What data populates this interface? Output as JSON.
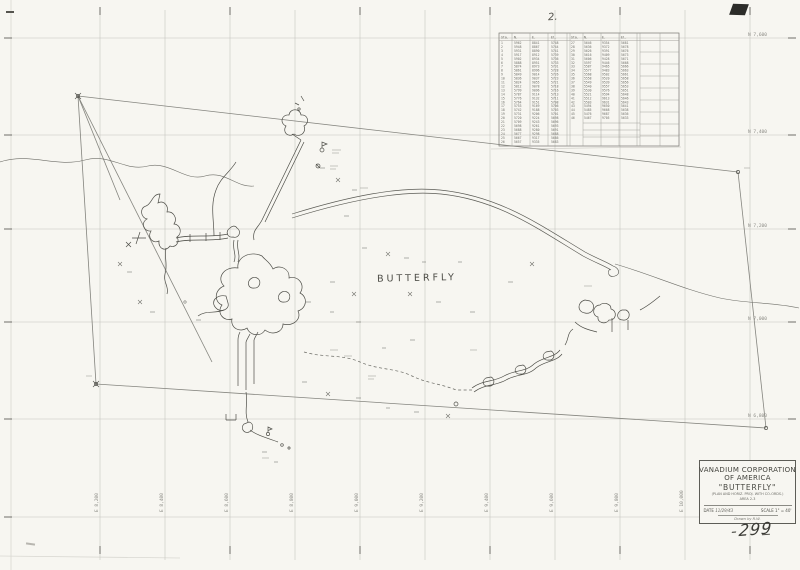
{
  "annotations": {
    "page_number": "299",
    "sheet_note": "2.",
    "map_label": "BUTTERFLY"
  },
  "title_block": {
    "company_line1": "VANADIUM CORPORATION",
    "company_line2": "OF AMERICA",
    "map_name": "\"BUTTERFLY\"",
    "subtitle": "(PLAN AND HORIZ. PROJ. WITH CO-ORDS.)",
    "area_line": "AREA 2-3",
    "date_label": "DATE",
    "date_value": "11/29/43",
    "scale_label": "SCALE",
    "scale_value": "1\" = 40'",
    "credit_line": "Drawn by R.W."
  },
  "grid": {
    "eastings": [
      {
        "x": 100,
        "label": "E 8,200"
      },
      {
        "x": 165,
        "label": "E 8,400"
      },
      {
        "x": 230,
        "label": "E 8,600"
      },
      {
        "x": 295,
        "label": "E 8,800"
      },
      {
        "x": 360,
        "label": "E 9,000"
      },
      {
        "x": 425,
        "label": "E 9,200"
      },
      {
        "x": 490,
        "label": "E 9,400"
      },
      {
        "x": 555,
        "label": "E 9,600"
      },
      {
        "x": 620,
        "label": "E 9,800"
      },
      {
        "x": 685,
        "label": "E 10,000"
      },
      {
        "x": 750,
        "label": "E 10,200"
      }
    ],
    "northings": [
      {
        "y": 38,
        "label": "N 7,600"
      },
      {
        "y": 135,
        "label": "N 7,400"
      },
      {
        "y": 229,
        "label": "N 7,200"
      },
      {
        "y": 322,
        "label": "N 7,000"
      },
      {
        "y": 419,
        "label": "N 6,800"
      },
      {
        "y": 517,
        "label": "N 6,600"
      }
    ]
  },
  "station_table": {
    "left_headers": [
      "Sta.",
      "N.",
      "E.",
      "El."
    ],
    "right_headers": [
      "Sta.",
      "N.",
      "E.",
      "El."
    ],
    "left_rows": [
      [
        "1",
        "5962",
        "8841",
        "5748"
      ],
      [
        "2",
        "5948",
        "8867",
        "5744"
      ],
      [
        "3",
        "5931",
        "8890",
        "5741"
      ],
      [
        "4",
        "5917",
        "8912",
        "5739"
      ],
      [
        "5",
        "5902",
        "8934",
        "5736"
      ],
      [
        "6",
        "5888",
        "8951",
        "5733"
      ],
      [
        "7",
        "5874",
        "8973",
        "5731"
      ],
      [
        "8",
        "5861",
        "8996",
        "5728"
      ],
      [
        "9",
        "5849",
        "9014",
        "5726"
      ],
      [
        "10",
        "5836",
        "9037",
        "5723"
      ],
      [
        "11",
        "5824",
        "9055",
        "5721"
      ],
      [
        "12",
        "5812",
        "9078",
        "5718"
      ],
      [
        "13",
        "5799",
        "9096",
        "5716"
      ],
      [
        "14",
        "5787",
        "9114",
        "5713"
      ],
      [
        "15",
        "5776",
        "9132",
        "5711"
      ],
      [
        "16",
        "5764",
        "9151",
        "5708"
      ],
      [
        "17",
        "5753",
        "9169",
        "5706"
      ],
      [
        "18",
        "5742",
        "9188",
        "5703"
      ],
      [
        "19",
        "5731",
        "9206",
        "5701"
      ],
      [
        "20",
        "5720",
        "9224",
        "5698"
      ],
      [
        "21",
        "5709",
        "9243",
        "5696"
      ],
      [
        "22",
        "5698",
        "9261",
        "5693"
      ],
      [
        "23",
        "5688",
        "9280",
        "5691"
      ],
      [
        "24",
        "5677",
        "9298",
        "5688"
      ],
      [
        "25",
        "5667",
        "9317",
        "5686"
      ],
      [
        "26",
        "5657",
        "9335",
        "5683"
      ]
    ],
    "right_rows": [
      [
        "27",
        "5646",
        "9354",
        "5681"
      ],
      [
        "28",
        "5636",
        "9372",
        "5678"
      ],
      [
        "29",
        "5626",
        "9391",
        "5676"
      ],
      [
        "30",
        "5616",
        "9409",
        "5673"
      ],
      [
        "31",
        "5606",
        "9428",
        "5671"
      ],
      [
        "32",
        "5597",
        "9446",
        "5668"
      ],
      [
        "33",
        "5587",
        "9465",
        "5666"
      ],
      [
        "34",
        "5577",
        "9483",
        "5663"
      ],
      [
        "35",
        "5568",
        "9502",
        "5661"
      ],
      [
        "36",
        "5558",
        "9520",
        "5658"
      ],
      [
        "37",
        "5549",
        "9539",
        "5656"
      ],
      [
        "38",
        "5540",
        "9557",
        "5653"
      ],
      [
        "39",
        "5530",
        "9576",
        "5651"
      ],
      [
        "40",
        "5521",
        "9594",
        "5648"
      ],
      [
        "41",
        "5512",
        "9613",
        "5646"
      ],
      [
        "42",
        "5503",
        "9631",
        "5643"
      ],
      [
        "43",
        "5494",
        "9650",
        "5641"
      ],
      [
        "44",
        "5485",
        "9668",
        "5638"
      ],
      [
        "45",
        "5476",
        "9687",
        "5636"
      ],
      [
        "46",
        "5467",
        "9705",
        "5633"
      ]
    ]
  }
}
